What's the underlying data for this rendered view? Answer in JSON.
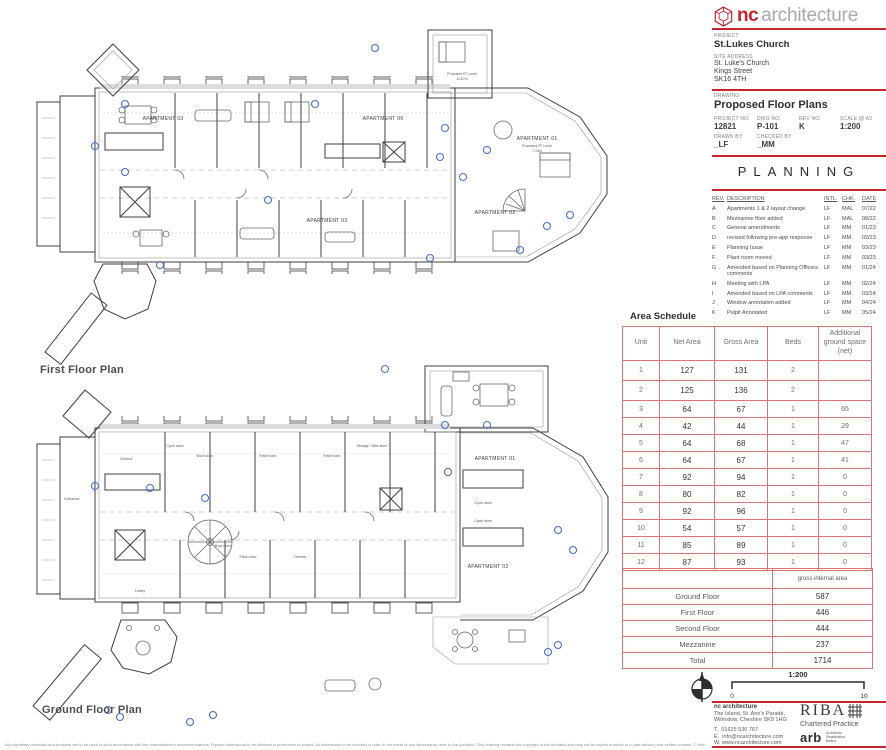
{
  "colors": {
    "accent_red": "#c5242b",
    "table_border": "#dd7575",
    "annotation_blue": "#4a6cd3"
  },
  "logo": {
    "nc": "nc",
    "architecture": "architecture"
  },
  "title_block": {
    "project_label": "PROJECT",
    "project": "St.Lukes Church",
    "site_address_label": "SITE ADDRESS",
    "site_address_1": "St. Luke's Church",
    "site_address_2": "Kings Street",
    "site_address_3": "SK16 4TH",
    "drawing_label": "DRAWING",
    "drawing": "Proposed Floor Plans",
    "project_no_label": "PROJECT NO.",
    "project_no": "12821",
    "dwg_no_label": "DWG NO.",
    "dwg_no": "P-101",
    "rev_no_label": "REV NO.",
    "rev_no": "K",
    "scale_label": "SCALE @ A3",
    "scale": "1:200",
    "drawn_by_label": "DRAWN BY",
    "drawn_by": "_LF",
    "checked_by_label": "CHECKED BY",
    "checked_by": "_MM"
  },
  "status": "PLANNING",
  "revisions": {
    "headers": {
      "rev": "REV.",
      "description": "DESCRIPTION",
      "intl": "INTL.",
      "chk": "CHK.",
      "date": "DATE"
    },
    "rows": [
      {
        "rev": "A",
        "desc": "Apartments 1 & 2 layout change",
        "intl": "LF",
        "chk": "MAL",
        "date": "07/22"
      },
      {
        "rev": "B",
        "desc": "Mezzanine floor added",
        "intl": "LF",
        "chk": "MAL",
        "date": "08/22"
      },
      {
        "rev": "C",
        "desc": "General amendments",
        "intl": "LF",
        "chk": "MM",
        "date": "01/23"
      },
      {
        "rev": "D",
        "desc": "revised following pre-app response",
        "intl": "LF",
        "chk": "MM",
        "date": "02/23"
      },
      {
        "rev": "E",
        "desc": "Planning Issue",
        "intl": "LF",
        "chk": "MM",
        "date": "03/23"
      },
      {
        "rev": "F",
        "desc": "Plant room moved",
        "intl": "LF",
        "chk": "MM",
        "date": "03/23"
      },
      {
        "rev": "G",
        "desc": "Amended based on Planning Officers comments",
        "intl": "LF",
        "chk": "MM",
        "date": "01/24"
      },
      {
        "rev": "H",
        "desc": "Meeting with LPA",
        "intl": "LF",
        "chk": "MM",
        "date": "02/24"
      },
      {
        "rev": "I",
        "desc": "Amended based on LPA comments",
        "intl": "LF",
        "chk": "MM",
        "date": "03/24"
      },
      {
        "rev": "J",
        "desc": "Window annotation added",
        "intl": "LF",
        "chk": "MM",
        "date": "04/24"
      },
      {
        "rev": "K",
        "desc": "Pulpit Annotated",
        "intl": "LF",
        "chk": "MM",
        "date": "05/24"
      }
    ]
  },
  "area_schedule": {
    "title": "Area Schedule",
    "headers": [
      "Unit",
      "Net Area",
      "Gross Area",
      "Beds",
      "Additional ground space (net)"
    ],
    "rows": [
      [
        "1",
        "127",
        "131",
        "2",
        ""
      ],
      [
        "2",
        "125",
        "136",
        "2",
        ""
      ],
      [
        "3",
        "64",
        "67",
        "1",
        "65"
      ],
      [
        "4",
        "42",
        "44",
        "1",
        "29"
      ],
      [
        "5",
        "64",
        "68",
        "1",
        "47"
      ],
      [
        "6",
        "64",
        "67",
        "1",
        "41"
      ],
      [
        "7",
        "92",
        "94",
        "1",
        "0"
      ],
      [
        "8",
        "80",
        "82",
        "1",
        "0"
      ],
      [
        "9",
        "92",
        "96",
        "1",
        "0"
      ],
      [
        "10",
        "54",
        "57",
        "1",
        "0"
      ],
      [
        "11",
        "85",
        "89",
        "1",
        "0"
      ],
      [
        "12",
        "87",
        "93",
        "1",
        "0"
      ]
    ]
  },
  "floor_summary": {
    "header": "gross internal area",
    "rows": [
      [
        "Ground Floor",
        "587"
      ],
      [
        "First Floor",
        "446"
      ],
      [
        "Second Floor",
        "444"
      ],
      [
        "Mezzanine",
        "237"
      ],
      [
        "Total",
        "1714"
      ]
    ]
  },
  "scale_bar": {
    "ratio": "1:200",
    "start": "0",
    "end": "10"
  },
  "footer": {
    "firm": "nc architecture",
    "address_1": "The Island, St. Ann's Parade,",
    "address_2": "Wilmslow, Cheshire SK9 1HG",
    "phone_label": "T.",
    "phone": "01625 536 767",
    "email_label": "E.",
    "email": "info@ncarchitecture.com",
    "web_label": "W.",
    "web": "www.ncarchitecture.com",
    "riba": "RIBA",
    "riba_sub": "Chartered Practice",
    "arb": "arb",
    "arb_sub_1": "Architects",
    "arb_sub_2": "Registration",
    "arb_sub_3": "Board"
  },
  "plans": {
    "first_floor": {
      "title": "First Floor Plan",
      "apartment_03": "APARTMENT 03",
      "apartment_06": "APARTMENT 06",
      "apartment_01": "APARTMENT 01",
      "apartment_02": "APARTMENT 02",
      "apartment_03b": "APARTMENT 03",
      "ff_level_label": "Proposed FF Level",
      "ff_level_value": "7.16m",
      "tower_level_value": "11.57m"
    },
    "ground_floor": {
      "title": "Ground Floor Plan",
      "apartment_01": "APARTMENT 01",
      "apartment_02": "APARTMENT 02",
      "entrance": "Entrance",
      "lobby": "Lobby",
      "cinema": "Cinema",
      "cycle_store": "Cycle store",
      "boot_room": "Boot room",
      "plant_room": "Plant room",
      "storage": "Storage / Bike store"
    }
  },
  "disclaimer": "All proprietary materials and products are to be used in strict accordance with the manufacturer's recommendations. Figured dimensions to be followed in preference to scaled. All dimensions to be checked on site. In the event of any discrepancy refer to the Architect. This drawing remains the copyright of the Architect and may not be copied in whole or in part without prior written consent. © Neil Collins Homes Ltd. t/a NC Architecture 2022"
}
